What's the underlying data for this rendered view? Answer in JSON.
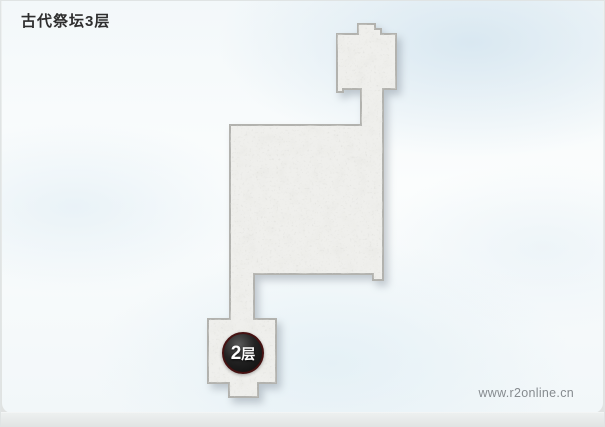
{
  "page": {
    "title": "古代祭坛3层",
    "watermark": "www.r2online.cn"
  },
  "map": {
    "name": "ancient-altar-level-3-map",
    "outline_path": "M357,23 H374 V28 H380 V33 H395 V88 H382 V279 H372 V273 H253 V318 H275 V382 H257 V396 H228 V382 H207 V318 H229 V124 H360 V88 H342 V91 H336 V33 H357 Z",
    "colors": {
      "floor": "#efefec",
      "speckle_coarse": "#cccbc5",
      "speckle_fine": "#b3b3ac",
      "outline": "#b2b2ae",
      "shadow": "rgba(110,120,135,0.38)"
    },
    "marker": {
      "label": "2层",
      "bg": "#1a1a1a",
      "ring": "#451212",
      "text_color": "#ffffff"
    }
  }
}
